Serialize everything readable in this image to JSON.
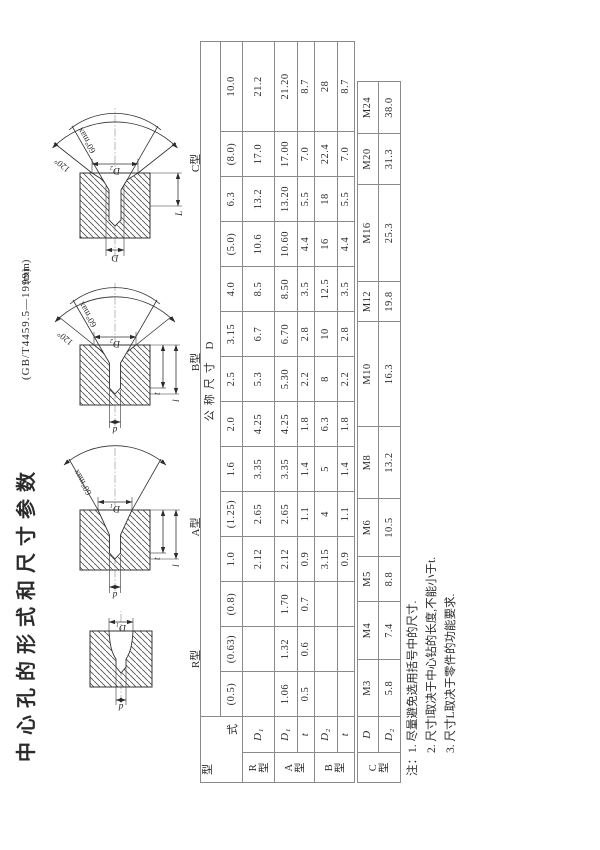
{
  "page": {
    "title": "中心孔的形式和尺寸参数",
    "standard": "(GB/T4459.5—1999)",
    "unit": "(mm)"
  },
  "figures": {
    "r": {
      "name": "R型",
      "mouth_dim": "D₁",
      "hole_dim": "d"
    },
    "a": {
      "name": "A型",
      "mouth_dim": "D₁",
      "hole_dim": "d",
      "angle60": "60°max",
      "t_dim": "t",
      "l_dim": "l"
    },
    "b": {
      "name": "B型",
      "mouth_dim": "D₂",
      "hole_dim": "d",
      "angle60": "60°max",
      "angle120": "120°",
      "t_dim": "t",
      "l_dim": "l"
    },
    "c": {
      "name": "C型",
      "mouth_dim": "D₂",
      "thread_dim": "D",
      "angle60": "60°max",
      "angle120": "120°",
      "L_dim": "L"
    }
  },
  "tables": {
    "main": {
      "corner": {
        "c1": "型",
        "c2": "式"
      },
      "dim_header": "公称尺寸 D",
      "sizes": [
        "(0.5)",
        "(0.63)",
        "(0.8)",
        "1.0",
        "(1.25)",
        "1.6",
        "2.0",
        "2.5",
        "3.15",
        "4.0",
        "(5.0)",
        "6.3",
        "(8.0)",
        "10.0"
      ],
      "groups": {
        "r": {
          "label": "R型",
          "rows": [
            {
              "sub": "D₁",
              "values": [
                "",
                "",
                "",
                "2.12",
                "2.65",
                "3.35",
                "4.25",
                "5.3",
                "6.7",
                "8.5",
                "10.6",
                "13.2",
                "17.0",
                "21.2"
              ]
            }
          ]
        },
        "a": {
          "label": "A型",
          "rows": [
            {
              "sub": "D₁",
              "values": [
                "1.06",
                "1.32",
                "1.70",
                "2.12",
                "2.65",
                "3.35",
                "4.25",
                "5.30",
                "6.70",
                "8.50",
                "10.60",
                "13.20",
                "17.00",
                "21.20"
              ]
            },
            {
              "sub": "t",
              "values": [
                "0.5",
                "0.6",
                "0.7",
                "0.9",
                "1.1",
                "1.4",
                "1.8",
                "2.2",
                "2.8",
                "3.5",
                "4.4",
                "5.5",
                "7.0",
                "8.7"
              ]
            }
          ]
        },
        "b": {
          "label": "B型",
          "rows": [
            {
              "sub": "D₂",
              "values": [
                "",
                "",
                "",
                "3.15",
                "4",
                "5",
                "6.3",
                "8",
                "10",
                "12.5",
                "16",
                "18",
                "22.4",
                "28"
              ]
            },
            {
              "sub": "t",
              "values": [
                "",
                "",
                "",
                "0.9",
                "1.1",
                "1.4",
                "1.8",
                "2.2",
                "2.8",
                "3.5",
                "4.4",
                "5.5",
                "7.0",
                "8.7"
              ]
            }
          ]
        }
      }
    },
    "ctype": {
      "label": "C型",
      "rows": [
        {
          "sub": "D",
          "values": [
            "M3",
            "M4",
            "M5",
            "M6",
            "M8",
            "M10",
            "M12",
            "M16",
            "M20",
            "M24"
          ]
        },
        {
          "sub": "D₂",
          "values": [
            "5.8",
            "7.4",
            "8.8",
            "10.5",
            "13.2",
            "16.3",
            "19.8",
            "25.3",
            "31.3",
            "38.0"
          ]
        }
      ]
    }
  },
  "notes": {
    "n1": "注：1. 尽量避免选用括号中的尺寸.",
    "n2": "2. 尺寸l取决于中心钻的长度,不能小于t.",
    "n3": "3. 尺寸L取决于零件的功能要求."
  }
}
